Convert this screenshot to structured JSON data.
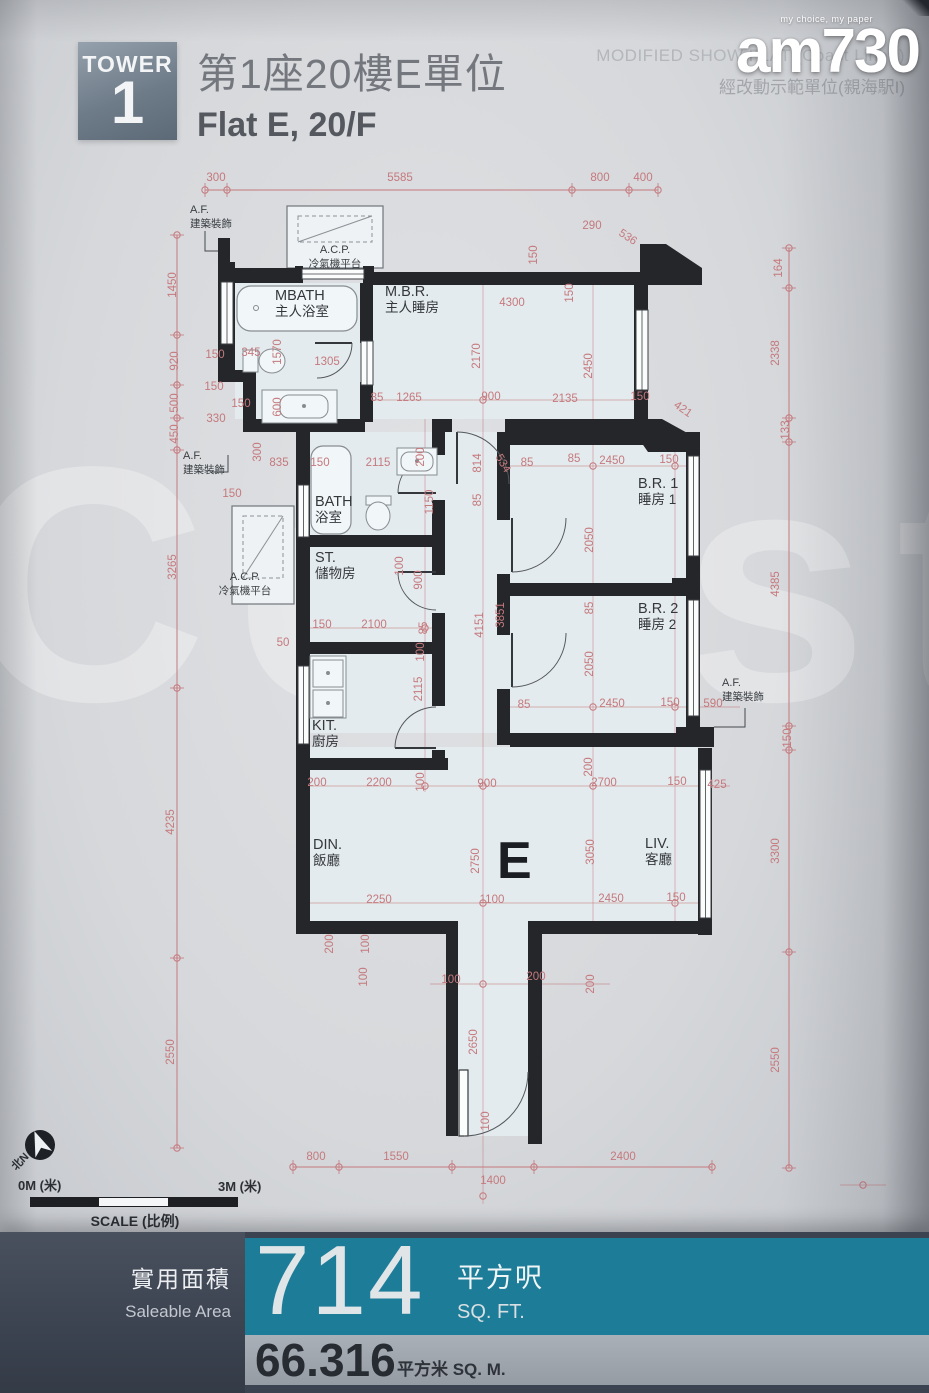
{
  "header": {
    "tower_label": "TOWER",
    "tower_number": "1",
    "title_cn": "第1座20樓E單位",
    "title_en": "Flat E, 20/F",
    "note_en": "MODIFIED SHOW FLAT (Coast Line I)",
    "note_cn": "經改動示範單位(親海駅I)"
  },
  "logo": {
    "tagline": "my choice, my paper",
    "wordmark": "am730"
  },
  "watermark_text": "Coast",
  "plan": {
    "flat_letter": {
      "t": "E",
      "x": 497,
      "y": 878
    },
    "rooms": [
      {
        "en": "MBATH",
        "cn": "主人浴室",
        "x": 275,
        "y": 300
      },
      {
        "en": "M.B.R.",
        "cn": "主人睡房",
        "x": 385,
        "y": 296
      },
      {
        "en": "BATH",
        "cn": "浴室",
        "x": 315,
        "y": 506
      },
      {
        "en": "ST.",
        "cn": "儲物房",
        "x": 315,
        "y": 562
      },
      {
        "en": "KIT.",
        "cn": "廚房",
        "x": 312,
        "y": 730
      },
      {
        "en": "DIN.",
        "cn": "飯廳",
        "x": 313,
        "y": 849
      },
      {
        "en": "B.R. 1",
        "cn": "睡房 1",
        "x": 638,
        "y": 488
      },
      {
        "en": "B.R. 2",
        "cn": "睡房 2",
        "x": 638,
        "y": 613
      },
      {
        "en": "LIV.",
        "cn": "客廳",
        "x": 645,
        "y": 848
      }
    ],
    "af_en": "A.F.",
    "af_cn": "建築裝飾",
    "af_labels": [
      {
        "x": 190,
        "y": 213
      },
      {
        "x": 183,
        "y": 459
      },
      {
        "x": 722,
        "y": 686
      }
    ],
    "acp_en": "A.C.P.",
    "acp_cn": "冷氣機平台",
    "acp_labels": [
      {
        "x": 335,
        "y": 253
      },
      {
        "x": 245,
        "y": 580
      }
    ],
    "dims": [
      {
        "t": "300",
        "x": 216,
        "y": 181
      },
      {
        "t": "5585",
        "x": 400,
        "y": 181
      },
      {
        "t": "800",
        "x": 600,
        "y": 181
      },
      {
        "t": "400",
        "x": 643,
        "y": 181
      },
      {
        "t": "290",
        "x": 592,
        "y": 229
      },
      {
        "t": "536",
        "x": 626,
        "y": 240,
        "r": 33
      },
      {
        "t": "150",
        "x": 537,
        "y": 255,
        "r": -90
      },
      {
        "t": "164",
        "x": 782,
        "y": 268,
        "r": -90
      },
      {
        "t": "2338",
        "x": 779,
        "y": 353,
        "r": -90
      },
      {
        "t": "133",
        "x": 789,
        "y": 430,
        "r": -90
      },
      {
        "t": "4385",
        "x": 779,
        "y": 584,
        "r": -90
      },
      {
        "t": "150",
        "x": 791,
        "y": 738,
        "r": -90
      },
      {
        "t": "3300",
        "x": 779,
        "y": 851,
        "r": -90
      },
      {
        "t": "2550",
        "x": 779,
        "y": 1060,
        "r": -90
      },
      {
        "t": "1450",
        "x": 176,
        "y": 285,
        "r": -90
      },
      {
        "t": "920",
        "x": 178,
        "y": 361,
        "r": -90
      },
      {
        "t": "500",
        "x": 178,
        "y": 403,
        "r": -90
      },
      {
        "t": "450",
        "x": 178,
        "y": 434,
        "r": -90
      },
      {
        "t": "3265",
        "x": 176,
        "y": 567,
        "r": -90
      },
      {
        "t": "4235",
        "x": 174,
        "y": 822,
        "r": -90
      },
      {
        "t": "2550",
        "x": 174,
        "y": 1052,
        "r": -90
      },
      {
        "t": "150",
        "x": 215,
        "y": 358
      },
      {
        "t": "150",
        "x": 214,
        "y": 390
      },
      {
        "t": "150",
        "x": 241,
        "y": 407
      },
      {
        "t": "330",
        "x": 216,
        "y": 422
      },
      {
        "t": "150",
        "x": 232,
        "y": 497
      },
      {
        "t": "835",
        "x": 279,
        "y": 466
      },
      {
        "t": "300",
        "x": 261,
        "y": 452,
        "r": -90
      },
      {
        "t": "345",
        "x": 251,
        "y": 356
      },
      {
        "t": "1570",
        "x": 281,
        "y": 352,
        "r": -90
      },
      {
        "t": "1305",
        "x": 327,
        "y": 365
      },
      {
        "t": "600",
        "x": 281,
        "y": 407,
        "r": -90
      },
      {
        "t": "150",
        "x": 320,
        "y": 466
      },
      {
        "t": "4300",
        "x": 512,
        "y": 306
      },
      {
        "t": "150",
        "x": 573,
        "y": 293,
        "r": -90
      },
      {
        "t": "2170",
        "x": 480,
        "y": 356,
        "r": -90
      },
      {
        "t": "2450",
        "x": 592,
        "y": 366,
        "r": -90
      },
      {
        "t": "85",
        "x": 377,
        "y": 401
      },
      {
        "t": "1265",
        "x": 409,
        "y": 401
      },
      {
        "t": "900",
        "x": 491,
        "y": 400
      },
      {
        "t": "2135",
        "x": 565,
        "y": 402
      },
      {
        "t": "150",
        "x": 640,
        "y": 400
      },
      {
        "t": "421",
        "x": 681,
        "y": 412,
        "r": 35
      },
      {
        "t": "2115",
        "x": 378,
        "y": 466
      },
      {
        "t": "200",
        "x": 424,
        "y": 457,
        "r": -90
      },
      {
        "t": "814",
        "x": 481,
        "y": 463,
        "r": -90
      },
      {
        "t": "534",
        "x": 500,
        "y": 465,
        "r": 60
      },
      {
        "t": "85",
        "x": 481,
        "y": 500,
        "r": -90
      },
      {
        "t": "1150",
        "x": 433,
        "y": 502,
        "r": -90
      },
      {
        "t": "85",
        "x": 527,
        "y": 466
      },
      {
        "t": "85",
        "x": 574,
        "y": 462
      },
      {
        "t": "2450",
        "x": 612,
        "y": 464
      },
      {
        "t": "150",
        "x": 669,
        "y": 463
      },
      {
        "t": "2050",
        "x": 593,
        "y": 540,
        "r": -90
      },
      {
        "t": "85",
        "x": 593,
        "y": 608,
        "r": -90
      },
      {
        "t": "2050",
        "x": 593,
        "y": 664,
        "r": -90
      },
      {
        "t": "3851",
        "x": 504,
        "y": 615,
        "r": -90
      },
      {
        "t": "4151",
        "x": 483,
        "y": 625,
        "r": -90
      },
      {
        "t": "100",
        "x": 403,
        "y": 566,
        "r": -90
      },
      {
        "t": "900",
        "x": 422,
        "y": 580,
        "r": -90
      },
      {
        "t": "150",
        "x": 322,
        "y": 628
      },
      {
        "t": "2100",
        "x": 374,
        "y": 628
      },
      {
        "t": "50",
        "x": 283,
        "y": 646
      },
      {
        "t": "85",
        "x": 427,
        "y": 628,
        "r": -90
      },
      {
        "t": "100",
        "x": 424,
        "y": 652,
        "r": -90
      },
      {
        "t": "2115",
        "x": 422,
        "y": 689,
        "r": -90
      },
      {
        "t": "85",
        "x": 524,
        "y": 708
      },
      {
        "t": "2450",
        "x": 612,
        "y": 707
      },
      {
        "t": "150",
        "x": 670,
        "y": 706
      },
      {
        "t": "590",
        "x": 713,
        "y": 707
      },
      {
        "t": "200",
        "x": 317,
        "y": 786
      },
      {
        "t": "2200",
        "x": 379,
        "y": 786
      },
      {
        "t": "100",
        "x": 424,
        "y": 782,
        "r": -90
      },
      {
        "t": "900",
        "x": 487,
        "y": 787
      },
      {
        "t": "2700",
        "x": 604,
        "y": 786
      },
      {
        "t": "150",
        "x": 677,
        "y": 785
      },
      {
        "t": "425",
        "x": 717,
        "y": 788
      },
      {
        "t": "200",
        "x": 592,
        "y": 767,
        "r": -90
      },
      {
        "t": "3050",
        "x": 594,
        "y": 852,
        "r": -90
      },
      {
        "t": "2750",
        "x": 479,
        "y": 861,
        "r": -90
      },
      {
        "t": "2250",
        "x": 379,
        "y": 903
      },
      {
        "t": "1100",
        "x": 492,
        "y": 903
      },
      {
        "t": "2450",
        "x": 611,
        "y": 902
      },
      {
        "t": "150",
        "x": 676,
        "y": 901
      },
      {
        "t": "200",
        "x": 333,
        "y": 944,
        "r": -90
      },
      {
        "t": "100",
        "x": 369,
        "y": 944,
        "r": -90
      },
      {
        "t": "100",
        "x": 367,
        "y": 977,
        "r": -90
      },
      {
        "t": "100",
        "x": 451,
        "y": 983
      },
      {
        "t": "200",
        "x": 536,
        "y": 980
      },
      {
        "t": "200",
        "x": 594,
        "y": 984,
        "r": -90
      },
      {
        "t": "2650",
        "x": 477,
        "y": 1042,
        "r": -90
      },
      {
        "t": "100",
        "x": 489,
        "y": 1121,
        "r": -90
      },
      {
        "t": "800",
        "x": 316,
        "y": 1160
      },
      {
        "t": "1550",
        "x": 396,
        "y": 1160
      },
      {
        "t": "2400",
        "x": 623,
        "y": 1160
      },
      {
        "t": "1400",
        "x": 493,
        "y": 1184
      }
    ]
  },
  "scalebar": {
    "left_label": "0M (米)",
    "right_label": "3M (米)",
    "caption": "SCALE (比例)",
    "north_label": "北N"
  },
  "footer": {
    "label_cn": "實用面積",
    "label_en": "Saleable Area",
    "sqft": "714",
    "sqft_unit_cn": "平方呎",
    "sqft_unit_en": "SQ. FT.",
    "sqm": "66.316",
    "sqm_unit": "平方米 SQ. M."
  },
  "colors": {
    "teal": "#1d7d99",
    "navy": "#3c4350",
    "dim_red": "#c5797d",
    "wall": "#24262a"
  }
}
